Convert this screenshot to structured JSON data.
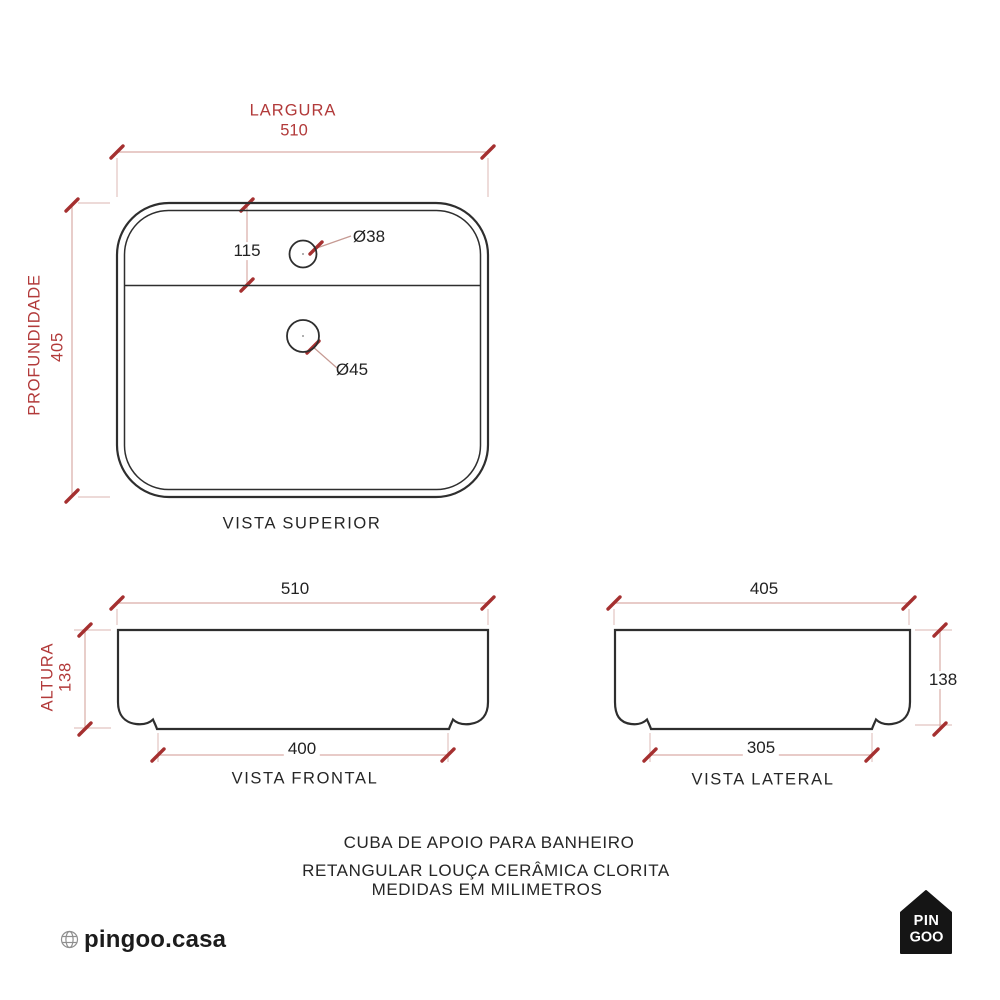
{
  "colors": {
    "accent_red_text": "#b23a3a",
    "tick_red": "#a53030",
    "dimension_line": "#d9aca7",
    "extension_line": "#e2c4c0",
    "drawing_line": "#2e2e2e",
    "logo_black": "#151515"
  },
  "top_view": {
    "label": "VISTA SUPERIOR",
    "width": {
      "label": "LARGURA",
      "value": "510"
    },
    "depth": {
      "label": "PROFUNDIDADE",
      "value": "405"
    },
    "hole_offset": "115",
    "faucet_hole": "Ø38",
    "drain_hole": "Ø45"
  },
  "front_view": {
    "label": "VISTA FRONTAL",
    "width": "510",
    "height": {
      "label": "ALTURA",
      "value": "138"
    },
    "base_width": "400"
  },
  "side_view": {
    "label": "VISTA LATERAL",
    "depth": "405",
    "height": "138",
    "base_width": "305"
  },
  "caption": {
    "line1": "CUBA DE APOIO PARA BANHEIRO",
    "line2": "RETANGULAR LOUÇA CERÂMICA CLORITA",
    "line3": "MEDIDAS EM MILIMETROS"
  },
  "footer": {
    "website": "pingoo.casa",
    "logo": {
      "line1": "PIN",
      "line2": "GOO"
    }
  }
}
